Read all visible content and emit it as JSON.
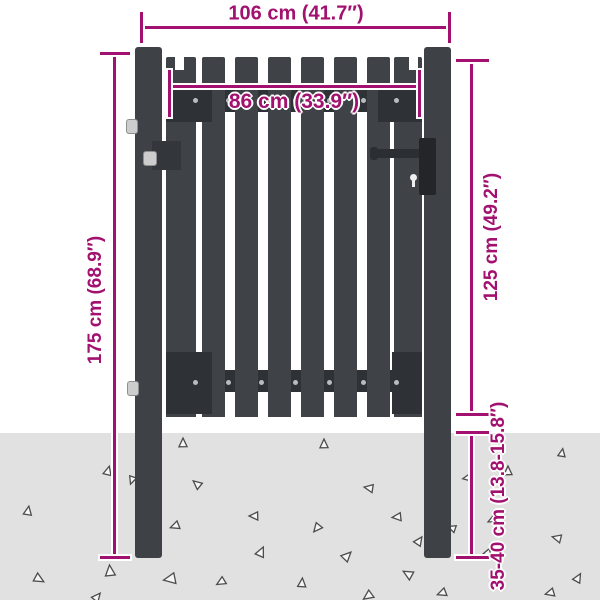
{
  "title": "Fence gate dimension diagram",
  "colors": {
    "dimension": "#a2116f",
    "steel": "#3e4246",
    "rail": "#2e3135",
    "lock": "#232528",
    "ground": "#e1e1e1",
    "background": "#ffffff",
    "rivet": "#b9bcbf",
    "hinge_pin": "#cdcdcd",
    "triangle_stroke": "#4c4c4c"
  },
  "dims": {
    "total_width": "106 cm (41.7″)",
    "inner_width": "86 cm (33.9″)",
    "total_height": "175 cm (68.9″)",
    "gate_height": "125 cm (49.2″)",
    "post_depth": "35-40 cm (13.8-15.8″)"
  },
  "gate": {
    "slat_count": 8,
    "rivets_per_rail": 7
  },
  "ground": {
    "triangles": [
      [
        108,
        471,
        15,
        9
      ],
      [
        132,
        480,
        200,
        8
      ],
      [
        28,
        511,
        10,
        9
      ],
      [
        110,
        571,
        355,
        11
      ],
      [
        39,
        579,
        120,
        10
      ],
      [
        97,
        597,
        40,
        9
      ],
      [
        183,
        443,
        0,
        9
      ],
      [
        197,
        484,
        310,
        9
      ],
      [
        175,
        526,
        250,
        9
      ],
      [
        170,
        579,
        260,
        12
      ],
      [
        221,
        582,
        240,
        9
      ],
      [
        254,
        516,
        270,
        9
      ],
      [
        261,
        552,
        25,
        10
      ],
      [
        302,
        583,
        5,
        9
      ],
      [
        324,
        444,
        0,
        9
      ],
      [
        317,
        528,
        220,
        9
      ],
      [
        347,
        556,
        45,
        10
      ],
      [
        369,
        488,
        280,
        9
      ],
      [
        368,
        596,
        235,
        10
      ],
      [
        397,
        517,
        265,
        9
      ],
      [
        408,
        574,
        300,
        10
      ],
      [
        419,
        541,
        35,
        9
      ],
      [
        442,
        593,
        250,
        9
      ],
      [
        452,
        528,
        290,
        8
      ],
      [
        467,
        478,
        260,
        8
      ],
      [
        492,
        520,
        245,
        8
      ],
      [
        487,
        553,
        255,
        8
      ],
      [
        508,
        471,
        0,
        9
      ],
      [
        562,
        453,
        10,
        8
      ],
      [
        557,
        538,
        285,
        9
      ],
      [
        578,
        578,
        30,
        9
      ],
      [
        550,
        593,
        255,
        9
      ]
    ]
  }
}
